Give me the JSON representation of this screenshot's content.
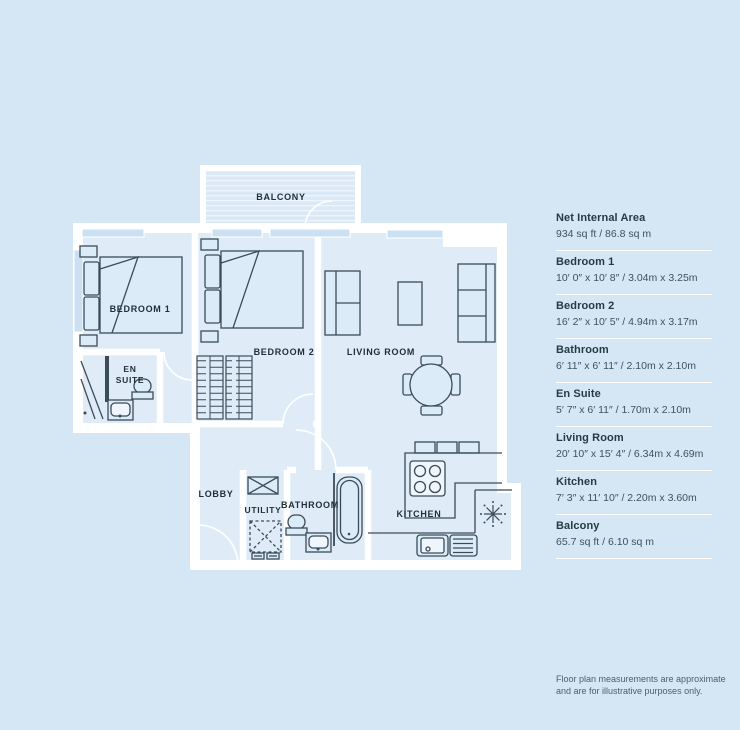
{
  "colors": {
    "background": "#d5e6f5",
    "wall": "#ffffff",
    "plan_line": "#3b4b58",
    "floor": "#dfecf8",
    "text": "#263a46"
  },
  "plan": {
    "rooms": {
      "balcony": "BALCONY",
      "bedroom1": "BEDROOM 1",
      "bedroom2": "BEDROOM 2",
      "living_room": "LIVING ROOM",
      "en_suite_line1": "EN",
      "en_suite_line2": "SUITE",
      "lobby": "LOBBY",
      "utility": "UTILITY",
      "bathroom": "BATHROOM",
      "kitchen": "KITCHEN"
    }
  },
  "sidebar": {
    "items": [
      {
        "label": "Net Internal Area",
        "value": "934 sq ft / 86.8 sq m"
      },
      {
        "label": "Bedroom 1",
        "value": "10′ 0″ x 10′ 8″ / 3.04m x 3.25m"
      },
      {
        "label": "Bedroom 2",
        "value": "16′ 2″ x 10′ 5″ / 4.94m x 3.17m"
      },
      {
        "label": "Bathroom",
        "value": "6′ 11″ x 6′ 11″ / 2.10m x 2.10m"
      },
      {
        "label": "En Suite",
        "value": "5′ 7″ x 6′ 11″ / 1.70m x 2.10m"
      },
      {
        "label": "Living Room",
        "value": "20′ 10″ x 15′ 4″ / 6.34m x 4.69m"
      },
      {
        "label": "Kitchen",
        "value": "7′ 3″ x 11′ 10″ / 2.20m x 3.60m"
      },
      {
        "label": "Balcony",
        "value": "65.7 sq ft / 6.10 sq m"
      }
    ]
  },
  "footer": {
    "line1": "Floor plan measurements are approximate",
    "line2": "and are for illustrative purposes only."
  }
}
